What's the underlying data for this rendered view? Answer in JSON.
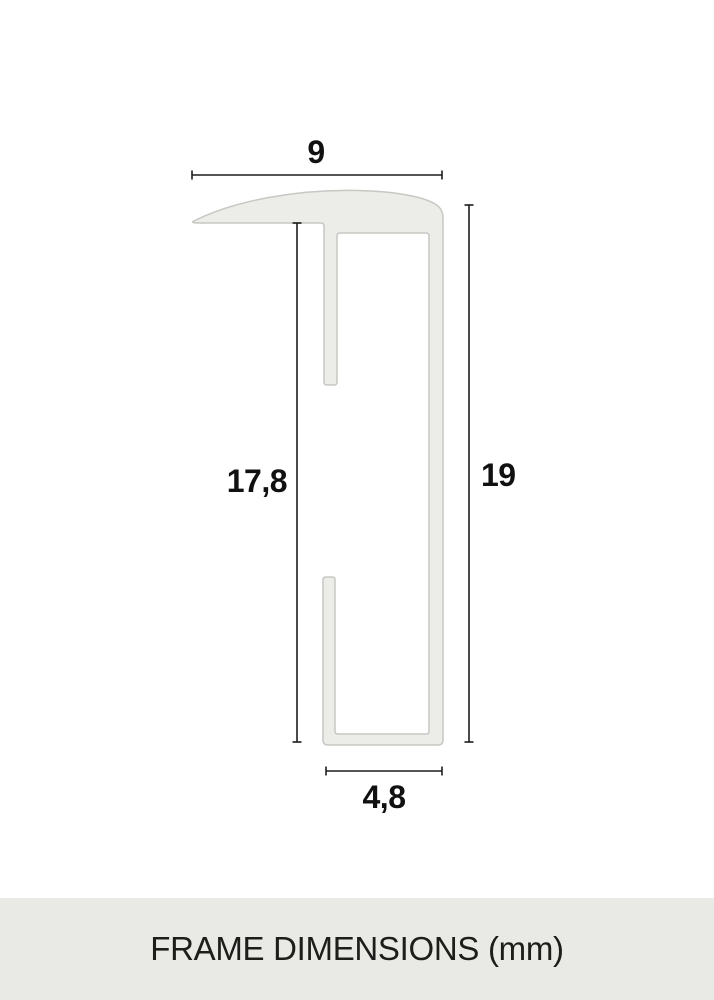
{
  "diagram": {
    "title": "frame profile cross-section",
    "dimensions": {
      "top_width": "9",
      "left_height": "17,8",
      "right_height": "19",
      "bottom_width": "4,8"
    },
    "unit": "mm",
    "colors": {
      "profile_fill": "#ECECE8",
      "profile_stroke": "#C7C7C3",
      "dimension_line": "#1D1D1B",
      "label_text": "#111111"
    }
  },
  "footer": {
    "label": "FRAME DIMENSIONS (mm)",
    "colors": {
      "background": "#E9E9E5",
      "text": "#1D1D1B"
    }
  }
}
